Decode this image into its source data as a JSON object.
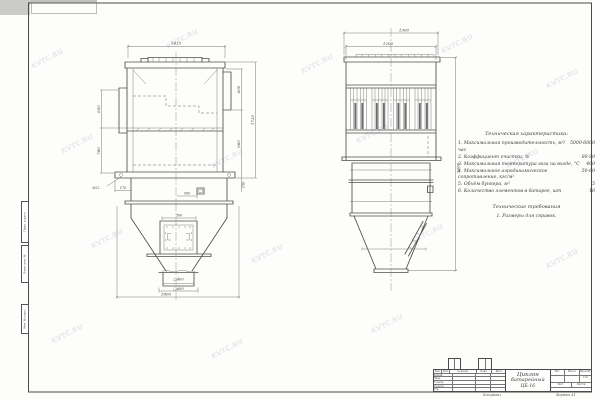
{
  "watermark": {
    "text": "KVTC.RU"
  },
  "margin_stamps": {
    "s1": "Подп. и дата",
    "s2": "Взам. инв. №",
    "s3": "Инв. № подл."
  },
  "front_view": {
    "dims": {
      "top_width": "1415",
      "left_upper": "600",
      "left_lower": "780",
      "hole_note": "Ø22",
      "base_offset": "170",
      "door_offset": "500",
      "panel_width": "300",
      "right_upper": "600",
      "right_mid": "960",
      "right_total": "1730",
      "right_base": "150",
      "outlet_inner": "□400",
      "outlet_flange": "□600",
      "bottom_width": "1800"
    }
  },
  "side_view": {
    "dims": {
      "outer_width": "1300",
      "inner_width": "1200",
      "total_height": "3000"
    }
  },
  "notes": {
    "title": "Техническая характеристика:",
    "items": [
      {
        "label": "1. Максимальная производительность, м³/час",
        "value": "5000-6000"
      },
      {
        "label": "2. Коэффициент очистки, %",
        "value": "80-90"
      },
      {
        "label": "3. Максимальная температура газа на входе, °С",
        "value": "400"
      },
      {
        "label": "4. Максимальное аэродинамическое сопротивление, кгс/м²",
        "value": "50-60"
      },
      {
        "label": "5. Объём бункера, м³",
        "value": "5"
      },
      {
        "label": "6. Количество элементов в батарее, шт",
        "value": "16"
      }
    ],
    "requirements_title": "Технические требования",
    "requirements_item": "1. Размеры для справок."
  },
  "title_block": {
    "name_line1": "Циклон",
    "name_line2": "батарейный",
    "name_line3": "ЦБ-16",
    "headers": {
      "izm": "Изм.",
      "list": "Лист",
      "doc": "№ докум.",
      "sign": "Подп.",
      "date": "Дата"
    },
    "rows": [
      "Разраб.",
      "Пров.",
      "Т.контр.",
      "Н.контр.",
      "Утв."
    ],
    "lit": "Лит.",
    "mass": "Масса",
    "scale_label": "Масштаб",
    "scale_value": "1:10",
    "sheet_label": "Лист",
    "sheets_label": "Листов",
    "copied": "Копировал",
    "format": "Формат А1"
  }
}
